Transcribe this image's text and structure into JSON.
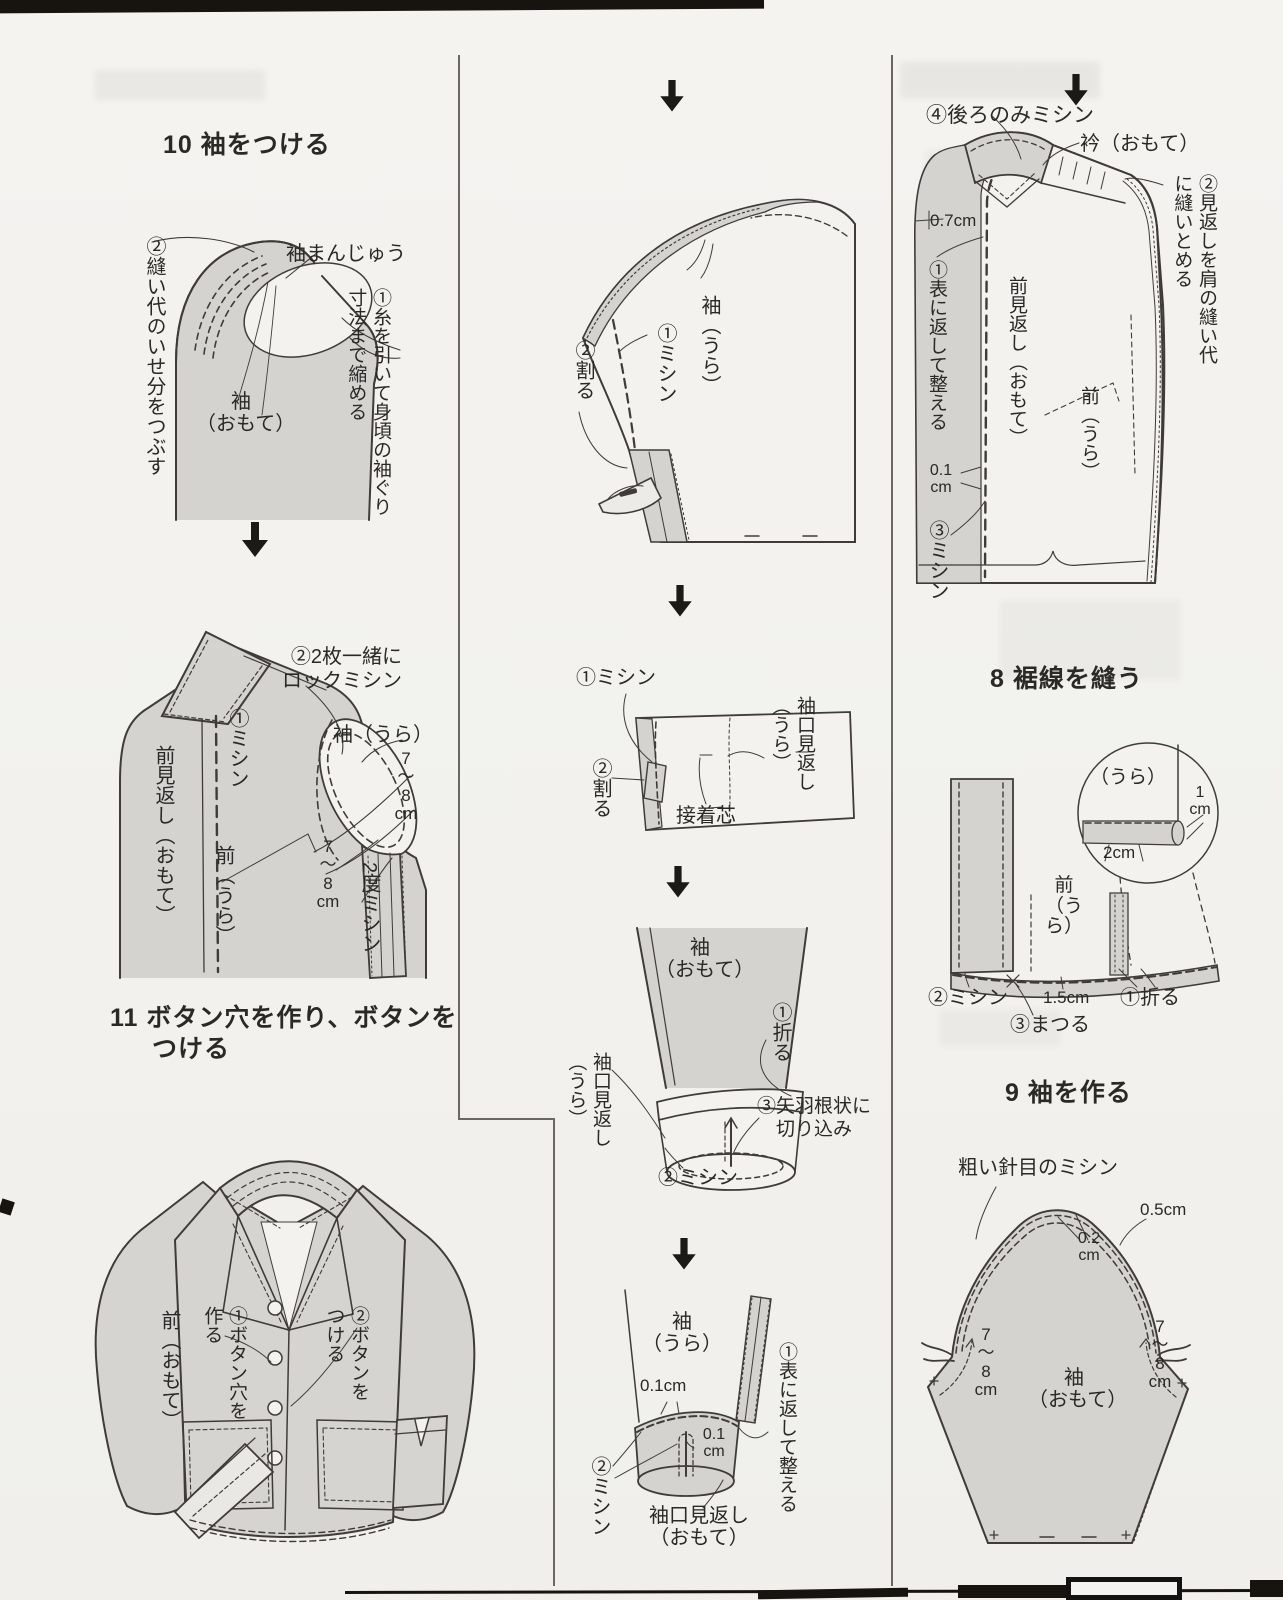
{
  "step10": {
    "heading": "10 袖をつける",
    "ease": "②縫い代のいせ分をつぶす",
    "manju": "袖まんじゅう",
    "shrink": "①糸を引いて身頃の袖ぐり寸法まで縮める",
    "sleeve_front": "袖\n（おもて）",
    "lock": "②2枚一緒に\nロックミシン",
    "stitch": "①ミシン",
    "sleeve_back": "袖（うら）",
    "front_facing": "前見返し（おもて）",
    "front_back": "前（うら）",
    "cm78_right": "7\n〜\n8\ncm",
    "cm78_left": "7\n〜\n8\ncm",
    "twice": "2度ミシン"
  },
  "step11": {
    "heading1": "11 ボタン穴を作り、ボタンを",
    "heading2": "つける",
    "front": "前（おもて）",
    "buttonhole": "①ボタン穴を作る",
    "button": "②ボタンをつける"
  },
  "sleeve_seam": {
    "stitch": "①ミシン",
    "press": "②割る",
    "sleeve_back": "袖（うら）"
  },
  "cuff_facing": {
    "stitch": "①ミシン",
    "press": "②割る",
    "facing": "袖口見返し（うら）",
    "interfacing": "接着芯"
  },
  "cuff_attach": {
    "sleeve": "袖\n（おもて）",
    "fold": "①折る",
    "facing": "袖口見返し（うら）",
    "clip": "③矢羽根状に\n　切り込み",
    "stitch": "②ミシン"
  },
  "cuff_finish": {
    "sleeve": "袖\n（うら）",
    "cm01a": "0.1cm",
    "cm01b": "0.1\ncm",
    "stitch": "②ミシン",
    "turn": "①表に返して整える",
    "facing": "袖口見返し\n（おもて）"
  },
  "body_facing": {
    "back_stitch": "④後ろのみミシン",
    "collar": "衿（おもて）",
    "tack": "②見返しを肩の縫い代に縫いとめる",
    "cm07": "0.7cm",
    "turn": "①表に返して整える",
    "front_facing": "前見返し（おもて）",
    "front_back": "前（うら）",
    "cm01": "0.1\ncm",
    "stitch": "③ミシン"
  },
  "step8": {
    "heading": "8 裾線を縫う",
    "inset_side": "（うら）",
    "cm1": "1\ncm",
    "cm2": "2cm",
    "front_back": "前\n（うら）",
    "stitch": "②ミシン",
    "cm15": "1.5cm",
    "blind": "③まつる",
    "fold": "①折る"
  },
  "step9": {
    "heading": "9 袖を作る",
    "baste": "粗い針目のミシン",
    "cm05": "0.5cm",
    "cm02": "0.2\ncm",
    "sleeve": "袖\n（おもて）",
    "cm78_left": "7\n〜\n8\ncm",
    "cm78_right": "7\n〜\n8\ncm"
  }
}
